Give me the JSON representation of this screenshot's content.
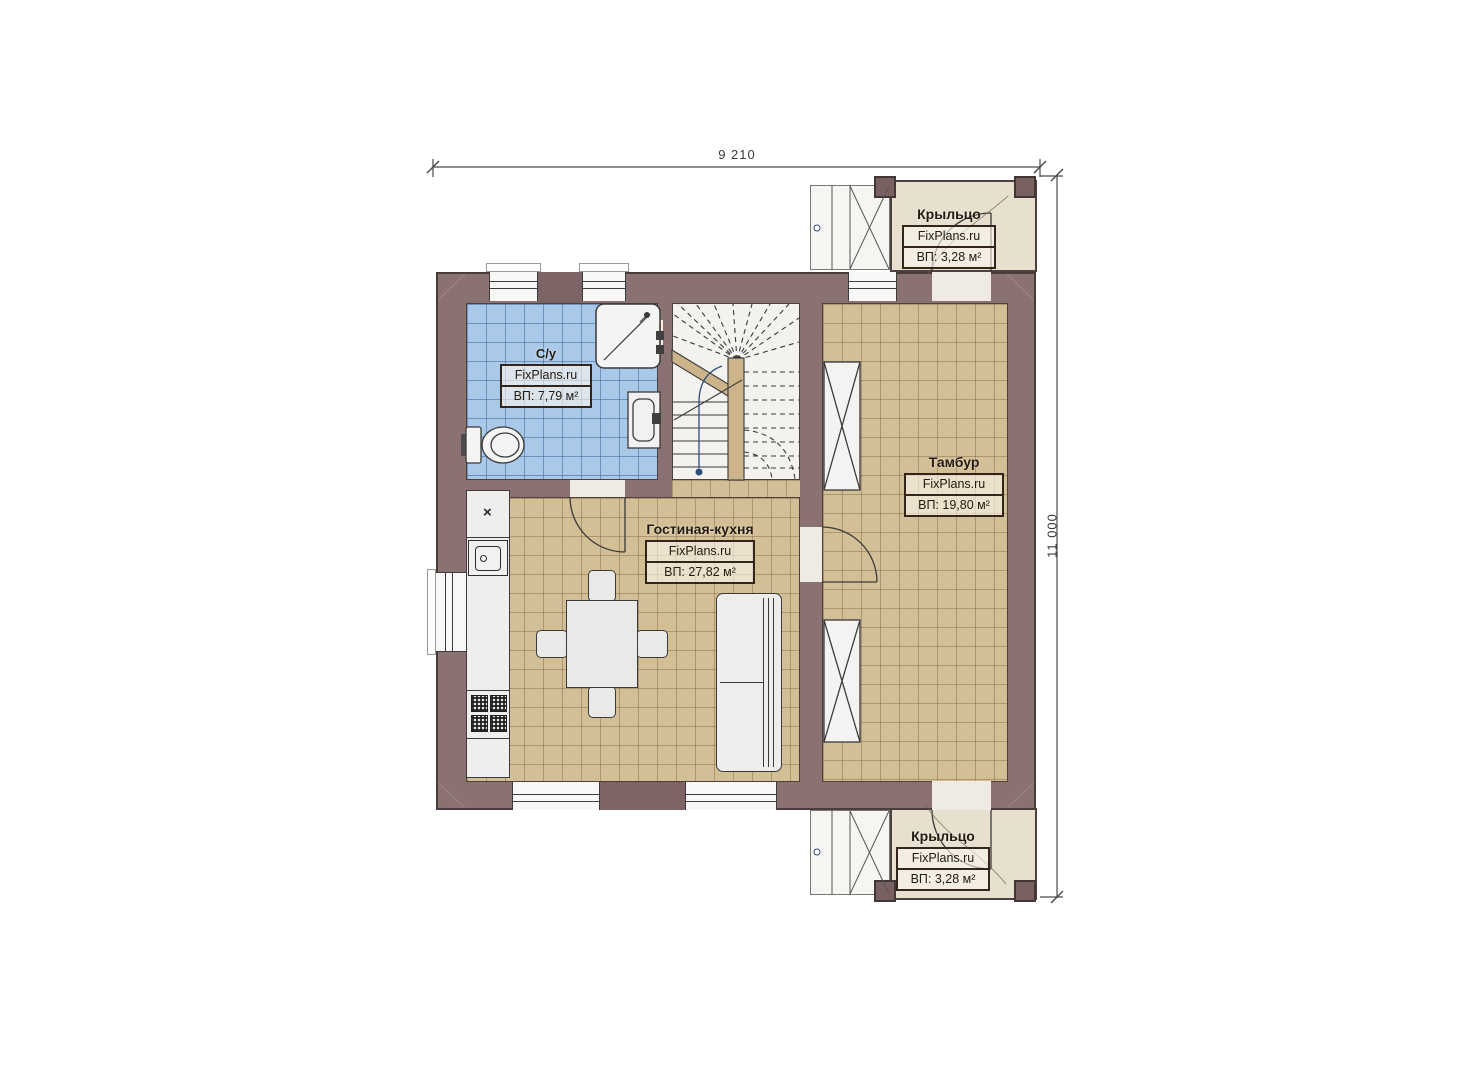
{
  "dimensions": {
    "width_label": "9 210",
    "height_label": "11 000"
  },
  "rooms": {
    "bathroom": {
      "name": "С/у",
      "brand": "FixPlans.ru",
      "area": "ВП: 7,79 м²"
    },
    "living": {
      "name": "Гостиная-кухня",
      "brand": "FixPlans.ru",
      "area": "ВП: 27,82 м²"
    },
    "tambour": {
      "name": "Тамбур",
      "brand": "FixPlans.ru",
      "area": "ВП: 19,80 м²"
    },
    "porch_top": {
      "name": "Крыльцо",
      "brand": "FixPlans.ru",
      "area": "ВП: 3,28 м²"
    },
    "porch_bottom": {
      "name": "Крыльцо",
      "brand": "FixPlans.ru",
      "area": "ВП: 3,28 м²"
    }
  },
  "kitchen": {
    "sink_mark": "×"
  },
  "colors": {
    "wall": "#8a7272",
    "wall_dark": "#7d6565",
    "bathroom_tile": "#aac9e9",
    "floor_tile": "#d3bf95",
    "porch_floor": "#e7e0cf",
    "stairs_floor": "#f3f2ef",
    "fixture_white": "#f2f1ef",
    "outline": "#3c3c3c",
    "accent_orange": "#e8854f",
    "newel_wood": "#cbb489",
    "walkline_dot": "#2e4e7e",
    "label_text": "#241a10"
  }
}
